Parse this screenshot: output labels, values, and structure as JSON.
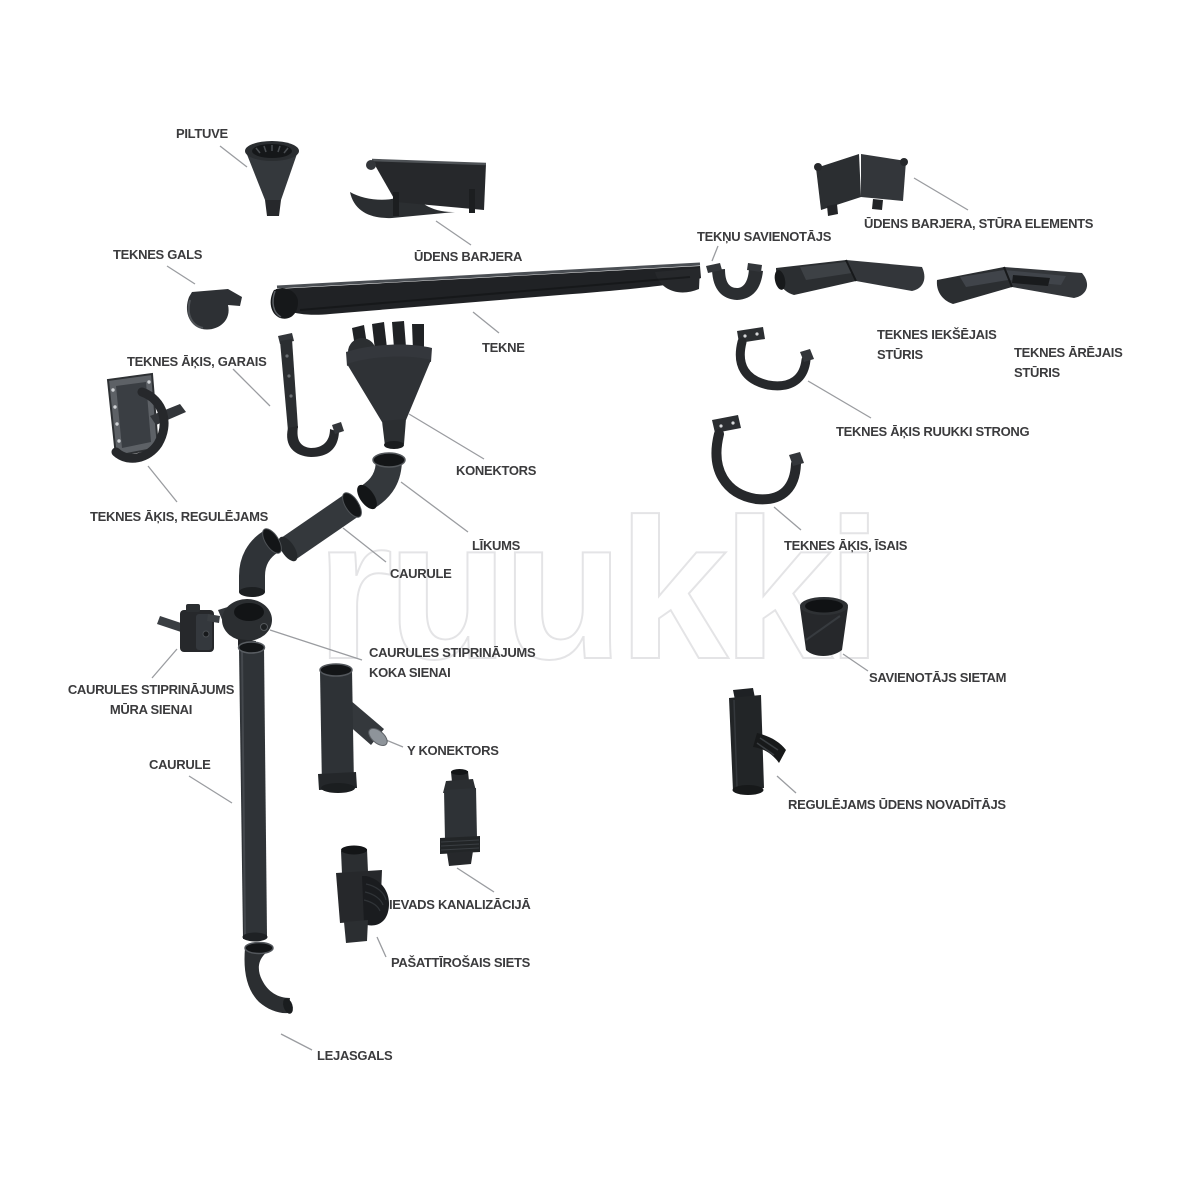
{
  "watermark": "ruukki",
  "colors": {
    "part_dark": "#26282b",
    "part_body": "#2e3134",
    "label_text": "#3b3b3d",
    "leader_line": "#9a9ca0",
    "watermark_outline": "#e4e4e6"
  },
  "labels": {
    "piltuve": "PILTUVE",
    "teknes_gals": "TEKNES GALS",
    "udens_barjera": "ŪDENS BARJERA",
    "tekne": "TEKNE",
    "teknu_savienotajs": "TEKŅU SAVIENOTĀJS",
    "udens_barjera_stura_elements": "ŪDENS BARJERA, STŪRA ELEMENTS",
    "teknes_ieksejais_sturis": "TEKNES IEKŠĒJAIS\nSTŪRIS",
    "teknes_arejais_sturis": "TEKNES ĀRĒJAIS\nSTŪRIS",
    "teknes_akis_garais": "TEKNES ĀĶIS, GARAIS",
    "teknes_akis_ruukki_strong": "TEKNES ĀĶIS RUUKKI STRONG",
    "teknes_akis_regulejams": "TEKNES ĀĶIS, REGULĒJAMS",
    "teknes_akis_isais": "TEKNES ĀĶIS, ĪSAIS",
    "konektors": "KONEKTORS",
    "likums": "LĪKUMS",
    "caurule_upper": "CAURULE",
    "savienotajs_sietam": "SAVIENOTĀJS SIETAM",
    "caurules_stiprinajums_mura_sienai": "CAURULES STIPRINĀJUMS\nMŪRA SIENAI",
    "caurules_stiprinajums_koka_sienai": "CAURULES STIPRINĀJUMS\nKOKA SIENAI",
    "caurule_lower": "CAURULE",
    "y_konektors": "Y KONEKTORS",
    "regulejams_udens_novaditajs": "REGULĒJAMS ŪDENS NOVADĪTĀJS",
    "ievads_kanalizacija": "IEVADS KANALIZĀCIJĀ",
    "pasattirosais_siets": "PAŠATTĪROŠAIS SIETS",
    "lejasgals": "LEJASGALS"
  }
}
